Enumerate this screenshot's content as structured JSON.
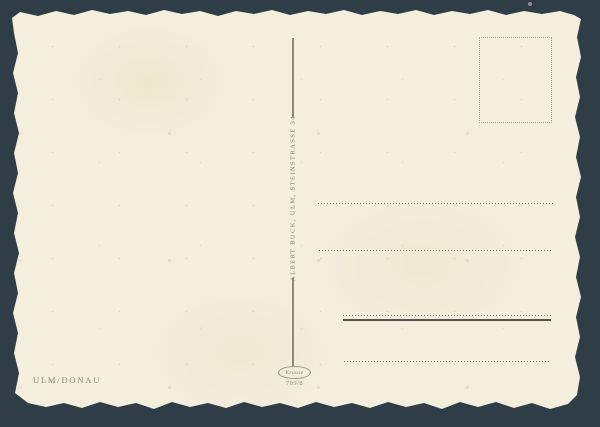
{
  "postcard": {
    "publisher_imprint": "ALBERT BUCK, ULM, STEINSTRASSE 34",
    "caption": "ULM/DONAU",
    "logo_text": "Krause",
    "series_number": "709/8"
  },
  "colors": {
    "background": "#2e3d46",
    "paper": "#f4eedd",
    "ink": "#877d6b",
    "dotted_rule": "#857b69",
    "solid_rule": "#55544c",
    "stamp_box_border": "#b3a78c"
  }
}
